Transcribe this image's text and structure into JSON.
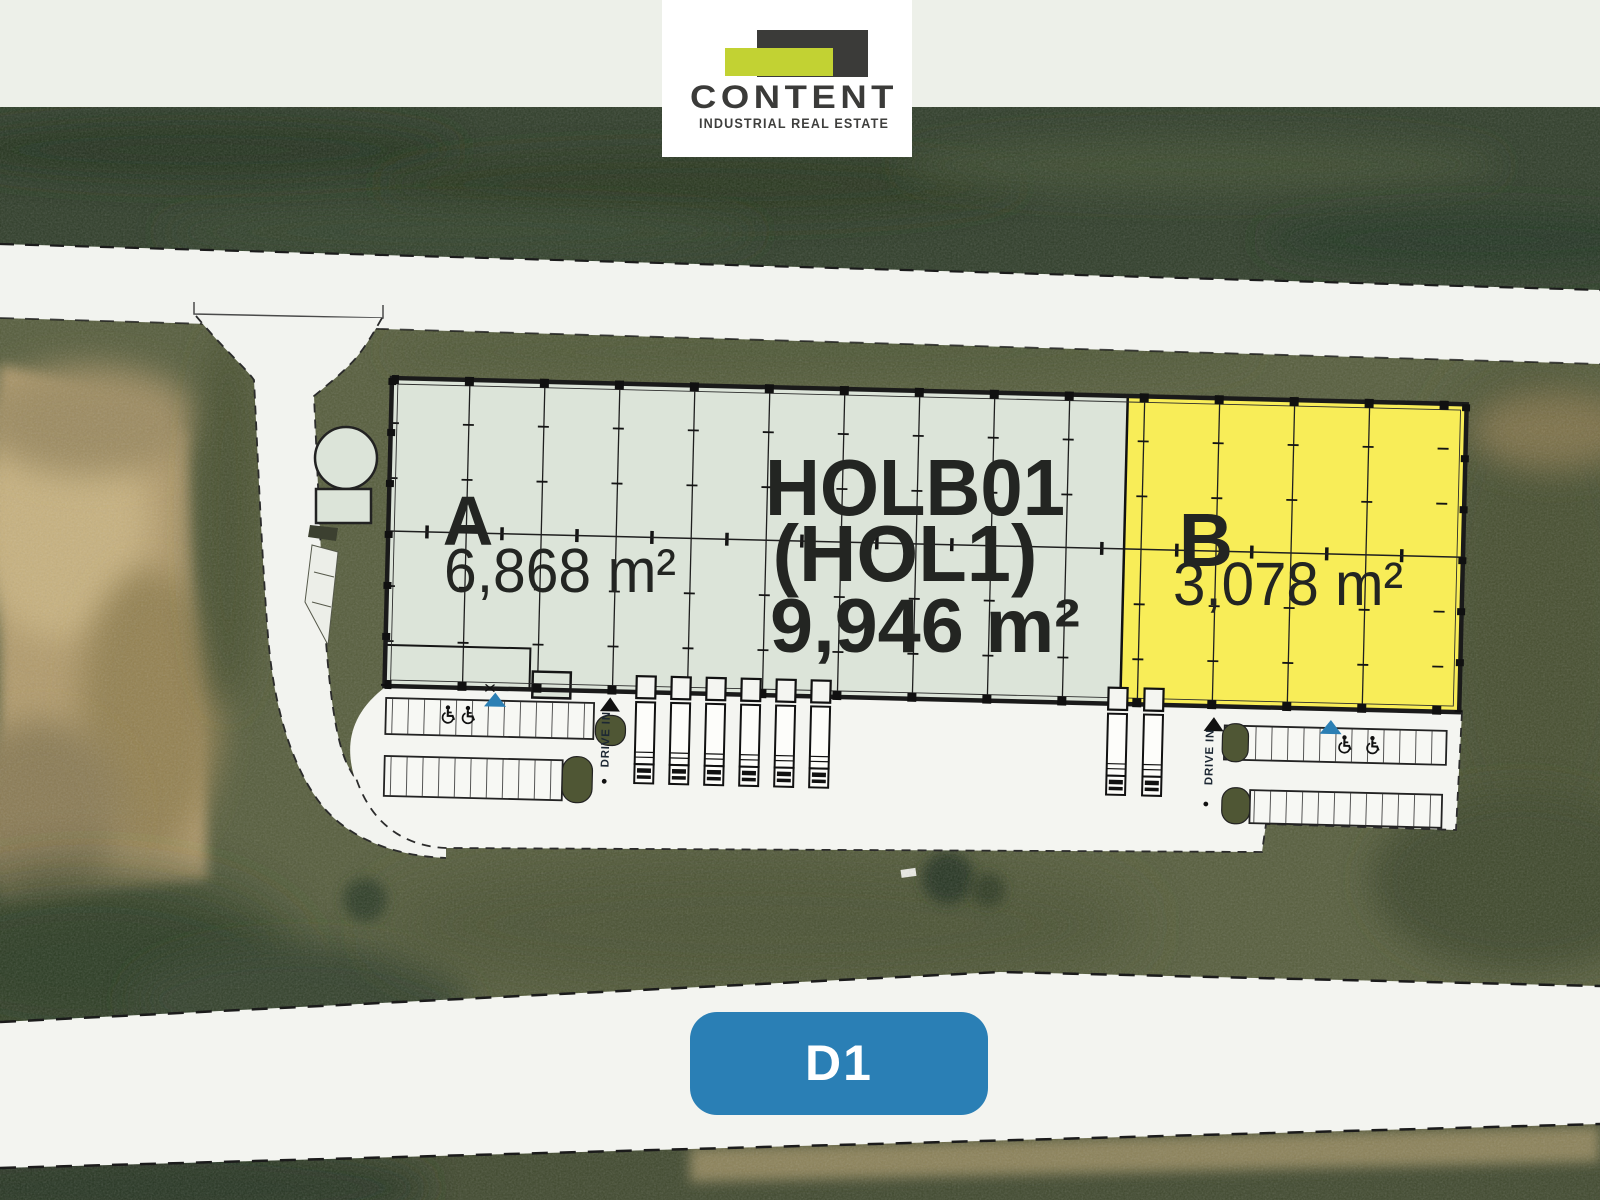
{
  "brand": {
    "name": "CONTENT",
    "tagline": "INDUSTRIAL REAL ESTATE",
    "logo_green": "#c2d233",
    "logo_dark": "#3b3b39"
  },
  "plan": {
    "building": {
      "code": "HOLB01",
      "alias": "(HOL1)",
      "total_area": "9,946 m²"
    },
    "units": [
      {
        "id": "A",
        "area": "6,868 m²",
        "fill": "#dce4d9"
      },
      {
        "id": "B",
        "area": "3,078 m²",
        "fill": "#f8ed58"
      }
    ],
    "drive_in_label": "DRIVE IN",
    "entrance_color": "#2b7fb4",
    "highway_badge": {
      "label": "D1",
      "fill": "#2a7fb5"
    }
  }
}
